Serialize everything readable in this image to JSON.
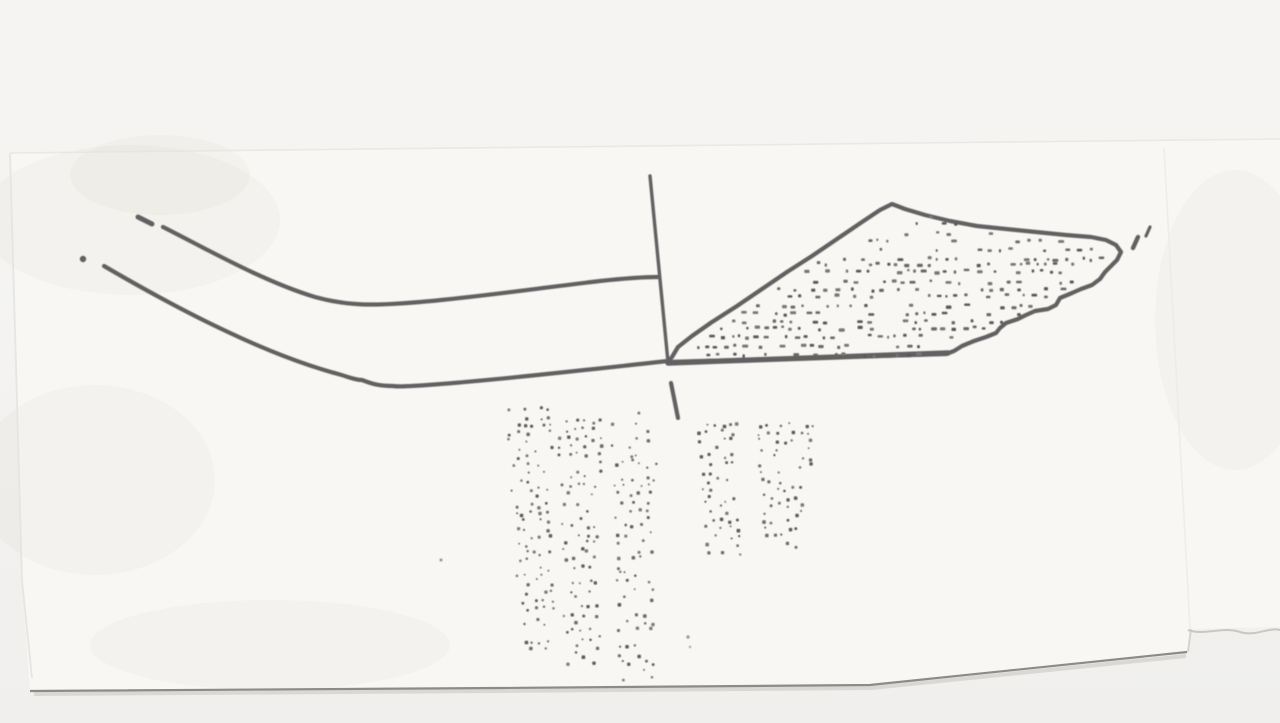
{
  "canvas": {
    "width": 1280,
    "height": 723
  },
  "colors": {
    "bg": "#f0efed",
    "bg_top": "#f5f4f2",
    "paper": "#f8f7f4",
    "ink": "#616161",
    "edge_dark": "#8d8b88",
    "edge_soft": "#d6d4d0",
    "edge_faint": "#e6e4e0",
    "tear": "#cac7c2",
    "crease": "#edebe7",
    "blotch": "#9b9790"
  },
  "paper": {
    "outline_points": "10,153 1280,138 1280,627 1191,629 1188,652 870,685 500,688 30,691 22,580",
    "top_edge": "M10,153 L1280,139",
    "left_edge": "M10,153 L22,580 L32,678",
    "bottom_shadow": "M34,694 L500,691 L872,688 L1186,656",
    "bottom_edge": "M30,691 L500,688 L870,685 L1187,652",
    "right_notch": "M1191,629 L1188,652",
    "tear_line": "M1188,630 C1205,636 1222,626 1240,632 C1255,637 1268,627 1280,630",
    "crease_line": "M1164,148 L1190,628",
    "blotches": [
      {
        "cx": 130,
        "cy": 220,
        "rx": 150,
        "ry": 75
      },
      {
        "cx": 95,
        "cy": 480,
        "rx": 120,
        "ry": 95
      },
      {
        "cx": 270,
        "cy": 645,
        "rx": 180,
        "ry": 45
      },
      {
        "cx": 1235,
        "cy": 320,
        "rx": 80,
        "ry": 150
      },
      {
        "cx": 160,
        "cy": 175,
        "rx": 90,
        "ry": 40
      }
    ]
  },
  "drawing": {
    "left_profile": {
      "top_dash": "M138,217 L152,224",
      "top_curve": "M163,227 C205,248 262,281 315,297 C348,306 372,306 420,302 C470,298 540,288 600,281 C628,278 648,277 658,277",
      "left_dot": {
        "cx": 83,
        "cy": 259,
        "r": 3.2
      },
      "bottom_curve": "M104,266 C140,287 185,312 228,332 C266,350 305,365 338,374 C349,377 355,380 362,380 C370,383 377,386 393,386 C400,387 405,386 411,386 C480,382 575,371 668,361"
    },
    "axis": {
      "line": "M650,176 L668,362",
      "tick": "M671,383 L678,418"
    },
    "section": {
      "outline": "M672,357 L678,347 L692,336 L712,322 L737,306 L762,289 L787,272 L812,256 L837,239 L862,222 L880,210 L892,204 L905,209 L925,215 L950,221 L977,226 L1006,229 L1036,232 L1066,235 L1091,237 L1106,240 L1116,245 L1121,252 L1117,260 L1111,266 L1105,272 L1100,279 L1092,285 L1081,289 L1072,293 L1060,298 L1056,305 L1048,309 L1035,311 L1026,315 L1018,319 L1006,323 L1000,328 L996,333 L986,337 L974,341 L962,346 L954,351 L946,354 L668,362 Z",
      "baseline": "M668,363 L948,353",
      "tip_mark_1": "M1133,248 L1138,237",
      "tip_mark_2": "M1146,236 L1150,227"
    },
    "specks": [
      {
        "cx": 441,
        "cy": 560,
        "r": 1.5
      },
      {
        "cx": 688,
        "cy": 637,
        "r": 1.6
      },
      {
        "cx": 690,
        "cy": 647,
        "r": 1.2
      }
    ]
  },
  "stipple": {
    "section_fill": {
      "type": "rows",
      "seed": 7,
      "y0": 216,
      "y1": 352,
      "step": 8,
      "left_bound": [
        [
          890,
          206
        ],
        [
          676,
          352
        ]
      ],
      "right_bound": [
        [
          892,
          204
        ],
        [
          1110,
          248
        ],
        [
          1118,
          252
        ],
        [
          1060,
          300
        ],
        [
          952,
          350
        ]
      ],
      "margin_left": 7,
      "margin_right": 9,
      "p_rows": [
        {
          "y_max": 252,
          "p": 0.36
        },
        {
          "y_max": 400,
          "p": 0.58
        }
      ],
      "dash_h": 2.4,
      "grays": [
        "#585858",
        "#696969",
        "#777777"
      ]
    },
    "bands": [
      {
        "type": "quad",
        "seed": 11,
        "top_cx": 528,
        "top_y": 408,
        "top_hw": 21,
        "bot_cx": 538,
        "bot_y": 650,
        "bot_hw": 15,
        "cell": 8,
        "p": 0.52,
        "grays": [
          "#5c5c5c",
          "#6d6d6d",
          "#7b7b7b"
        ]
      },
      {
        "type": "quad",
        "seed": 22,
        "top_cx": 580,
        "top_y": 421,
        "top_hw": 21,
        "bot_cx": 583,
        "bot_y": 661,
        "bot_hw": 17,
        "cell": 8,
        "p": 0.52,
        "grays": [
          "#5c5c5c",
          "#6d6d6d",
          "#7b7b7b"
        ]
      },
      {
        "type": "quad",
        "seed": 33,
        "top_cx": 633,
        "top_y": 413,
        "top_hw": 21,
        "bot_cx": 637,
        "bot_y": 681,
        "bot_hw": 17,
        "cell": 8,
        "p": 0.52,
        "grays": [
          "#5c5c5c",
          "#6d6d6d",
          "#7b7b7b"
        ]
      },
      {
        "type": "quad",
        "seed": 44,
        "top_cx": 717,
        "top_y": 423,
        "top_hw": 20,
        "bot_cx": 722,
        "bot_y": 557,
        "bot_hw": 16,
        "cell": 8,
        "p": 0.54,
        "grays": [
          "#5c5c5c",
          "#6d6d6d",
          "#7b7b7b"
        ]
      },
      {
        "type": "quad",
        "seed": 55,
        "top_cx": 786,
        "top_y": 424,
        "top_hw": 28,
        "bot_cx": 781,
        "bot_y": 546,
        "bot_hw": 17,
        "cell": 8,
        "p": 0.5,
        "grays": [
          "#5c5c5c",
          "#6d6d6d",
          "#7b7b7b"
        ]
      }
    ]
  }
}
